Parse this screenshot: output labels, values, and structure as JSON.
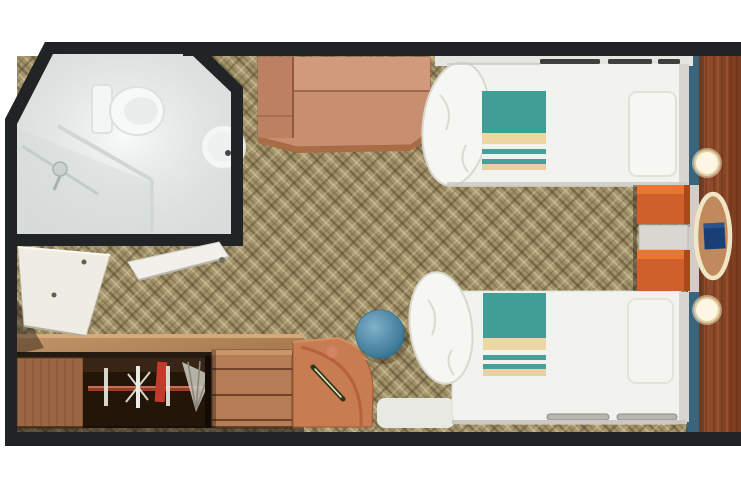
{
  "page": {
    "description_visible_text": ""
  },
  "colors": {
    "wall": "#212425",
    "background": "#ffffff",
    "carpet_base": "#a3946c",
    "carpet_shadow": "#55462b",
    "carpet_highlight": "#dbcda4",
    "bathroom_floor": "#edf0ef",
    "bed_linen": "#f2f2ee",
    "blanket_teal": "#3f9e95",
    "stripe_cream": "#ecd6a2",
    "stripe_peach": "#e9cfa6",
    "wood_sofa": "#c78e6f",
    "wood_counter": "#b9895f",
    "wood_wardrobe_door": "#9b6644",
    "wood_drawers": "#b57e57",
    "wood_wall_panel": "#8a4527",
    "corner_desk": "#c87c52",
    "trim_blue": "#39647e",
    "nightstand_orange": "#cf5f2b",
    "stool_blue": "#3b87ad",
    "table_ring_cream": "#f0e5c6",
    "table_object_blue": "#1a3f77",
    "door_panel": "#efece3",
    "rail_red": "#9c3a2c",
    "hanger_red": "#c23a2c",
    "hanger_white": "#eceae2",
    "light_warm": "#fdf6e3"
  }
}
